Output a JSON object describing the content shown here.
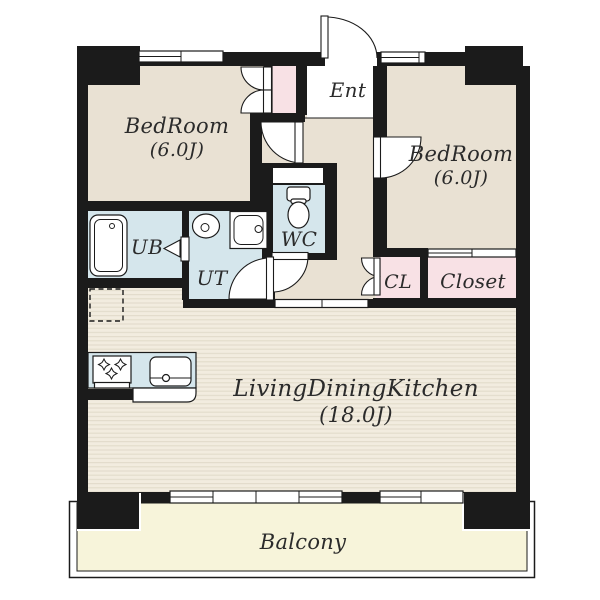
{
  "colors": {
    "wall": "#1b1b1b",
    "room_floor": "#e9e1d3",
    "wet_floor": "#d5e6ec",
    "closet_floor": "#f8e1e5",
    "balcony_floor": "#f7f4da",
    "ldk_floor": "#f2ecdf",
    "ldk_stripe": "#e2dbca",
    "fixture_fill": "#ffffff",
    "label": "#2b2b2b"
  },
  "rooms": {
    "bedroom1": {
      "label": "BedRoom",
      "size": "(6.0J)"
    },
    "bedroom2": {
      "label": "BedRoom",
      "size": "(6.0J)"
    },
    "entrance": {
      "label": "Ent"
    },
    "unit_bath": {
      "label": "UB"
    },
    "utility": {
      "label": "UT"
    },
    "toilet": {
      "label": "WC"
    },
    "closet_small": {
      "label": "CL"
    },
    "closet_large": {
      "label": "Closet"
    },
    "living_dining_kitchen": {
      "label": "LivingDiningKitchen",
      "size": "(18.0J)"
    },
    "balcony": {
      "label": "Balcony"
    }
  },
  "icons": {
    "bathtub": "bathtub fixture in UB",
    "washbasin": "oval washbasin in UT",
    "washing_machine": "washing machine pan in UT",
    "toilet": "toilet bowl in WC",
    "stove": "3-burner gas stove in kitchen",
    "kitchen_sink": "kitchen sink in counter",
    "refrigerator_space": "dashed refrigerator space in LDK"
  }
}
